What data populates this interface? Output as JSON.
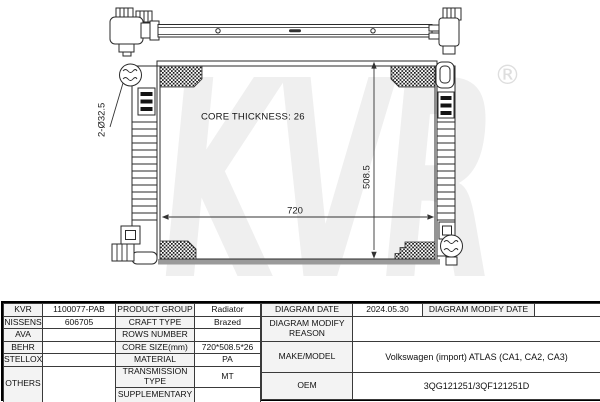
{
  "diagram": {
    "watermark_text": "KVR",
    "registered_mark": "®",
    "core_thickness_label": "CORE THICKNESS: 26",
    "width_dimension": "720",
    "height_dimension": "508.5",
    "pipe_diameter_label": "2-Ø32.5",
    "colors": {
      "line": "#2a2a2a",
      "watermark": "#efefef",
      "shadow": "#9a9a9a"
    }
  },
  "table": {
    "brands": [
      "KVR",
      "NISSENS",
      "AVA",
      "BEHR",
      "STELLOX",
      "OTHERS"
    ],
    "brand_codes": [
      "1100077-PAB",
      "606705"
    ],
    "specs": [
      {
        "label": "PRODUCT GROUP",
        "value": "Radiator"
      },
      {
        "label": "CRAFT TYPE",
        "value": "Brazed"
      },
      {
        "label": "ROWS NUMBER",
        "value": ""
      },
      {
        "label": "CORE SIZE(mm)",
        "value": "720*508.5*26"
      },
      {
        "label": "MATERIAL",
        "value": "PA"
      },
      {
        "label": "TRANSMISSION TYPE",
        "value": "MT"
      },
      {
        "label": "SUPPLEMENTARY",
        "value": ""
      }
    ],
    "diagram_date_label": "DIAGRAM DATE",
    "diagram_date_value": "2024.05.30",
    "diagram_modify_date_label": "DIAGRAM MODIFY DATE",
    "diagram_modify_reason_label": "DIAGRAM MODIFY REASON",
    "make_model_label": "MAKE/MODEL",
    "make_model_value": "Volkswagen (import) ATLAS (CA1, CA2, CA3)",
    "oem_label": "OEM",
    "oem_value": "3QG121251/3QF121251D"
  }
}
